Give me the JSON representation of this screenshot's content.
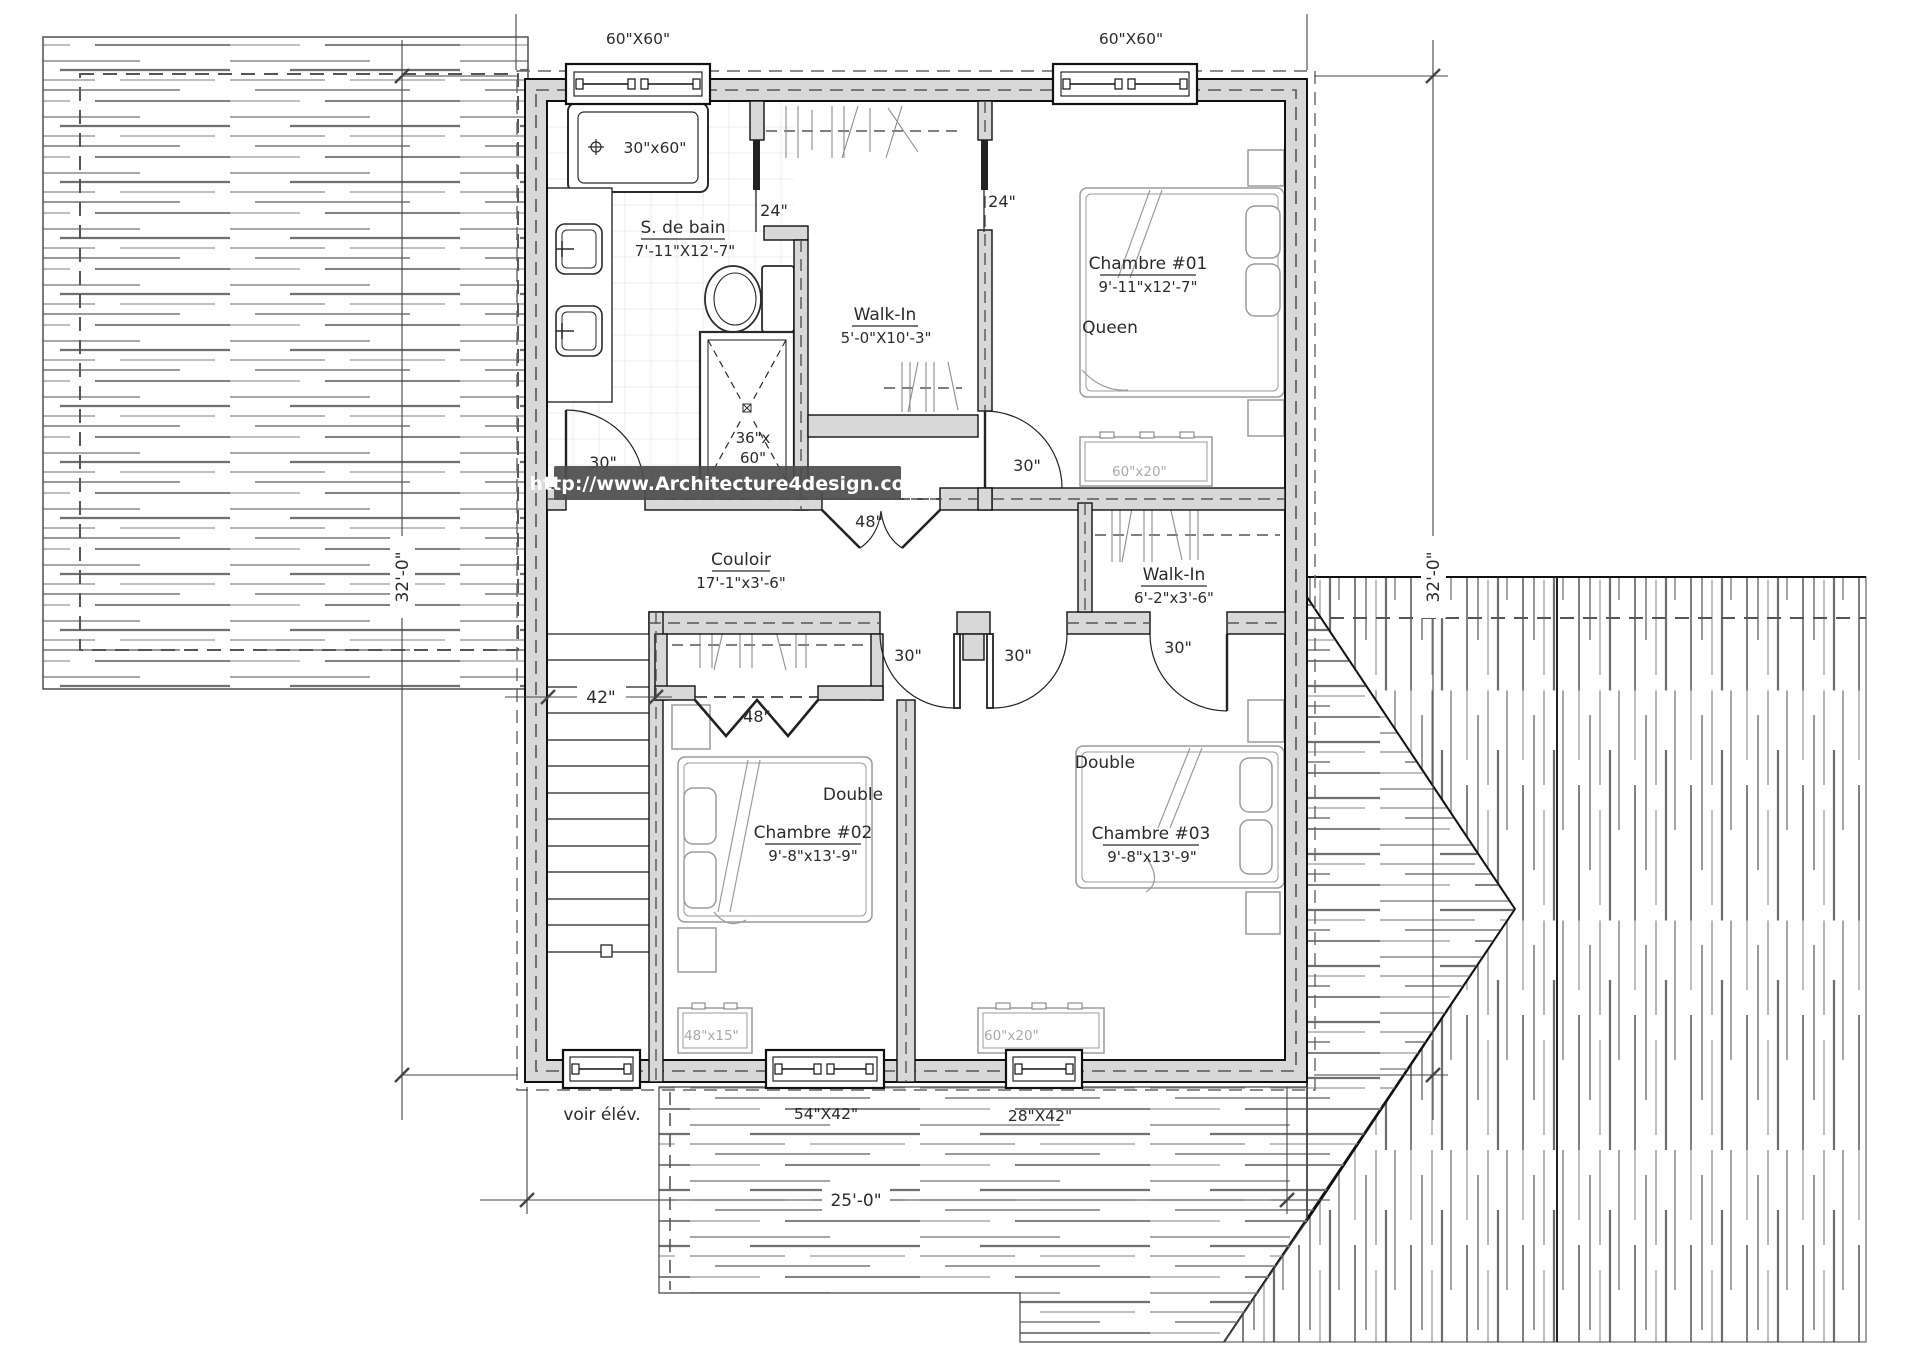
{
  "watermark": {
    "url": "http://www.Architecture4design.com"
  },
  "rooms": {
    "bathroom": {
      "name": "S. de bain",
      "dims": "7'-11\"X12'-7\""
    },
    "walkin1": {
      "name": "Walk-In",
      "dims": "5'-0\"X10'-3\""
    },
    "bedroom1": {
      "name": "Chambre #01",
      "dims": "9'-11\"x12'-7\"",
      "bed_type": "Queen"
    },
    "couloir": {
      "name": "Couloir",
      "dims": "17'-1\"x3'-6\""
    },
    "walkin2": {
      "name": "Walk-In",
      "dims": "6'-2\"x3'-6\""
    },
    "bedroom2": {
      "name": "Chambre #02",
      "dims": "9'-8\"x13'-9\"",
      "bed_type": "Double"
    },
    "bedroom3": {
      "name": "Chambre #03",
      "dims": "9'-8\"x13'-9\"",
      "bed_type": "Double"
    }
  },
  "fixtures": {
    "bathtub": "30\"x60\"",
    "shower_width": "36\"x",
    "shower_length": "60\""
  },
  "furniture": {
    "dresser_bedroom1": "60\"x20\"",
    "dresser_bedroom2": "48\"x15\"",
    "dresser_bedroom3": "60\"x20\""
  },
  "windows": {
    "top_left": "60\"X60\"",
    "top_right": "60\"X60\"",
    "bottom_center": "54\"X42\"",
    "bottom_right": "28\"X42\""
  },
  "doors": {
    "pocket_left": "24\"",
    "pocket_right": "24\"",
    "bathroom": "30\"",
    "bedroom1": "30\"",
    "walkin1_double": "48\"",
    "bedroom2": "30\"",
    "bedroom3": "30\"",
    "walkin2": "30\"",
    "closet_bifold": "48\""
  },
  "dimensions": {
    "plan_width": "25'-0\"",
    "plan_depth_left": "32'-0\"",
    "plan_depth_right": "32'-0\"",
    "stair_width": "42\"",
    "elevation_note": "voir élév."
  },
  "colors": {
    "wall_fill": "#d8d8d8",
    "line": "#1a1a1a",
    "watermark_bg": "#4d4d4d",
    "watermark_text": "#ffffff"
  }
}
